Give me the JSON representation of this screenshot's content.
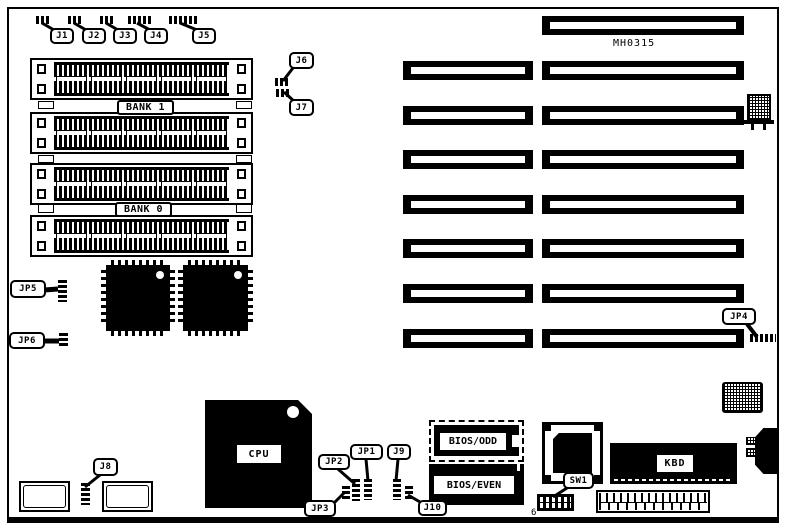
{
  "colors": {
    "ink": "#000000",
    "paper": "#ffffff"
  },
  "board": {
    "part_number": "MH0315"
  },
  "banks": {
    "bank1": "BANK 1",
    "bank0": "BANK 0"
  },
  "callouts": {
    "j1": "J1",
    "j2": "J2",
    "j3": "J3",
    "j4": "J4",
    "j5": "J5",
    "j6": "J6",
    "j7": "J7",
    "j8": "J8",
    "j9": "J9",
    "j10": "J10",
    "jp1": "JP1",
    "jp2": "JP2",
    "jp3": "JP3",
    "jp4": "JP4",
    "jp5": "JP5",
    "jp6": "JP6",
    "sw1": "SW1"
  },
  "chips": {
    "cpu": "CPU",
    "bios_odd": "BIOS/ODD",
    "bios_even": "BIOS/EVEN",
    "kbd": "KBD"
  },
  "switch": {
    "positions_count": "6"
  }
}
